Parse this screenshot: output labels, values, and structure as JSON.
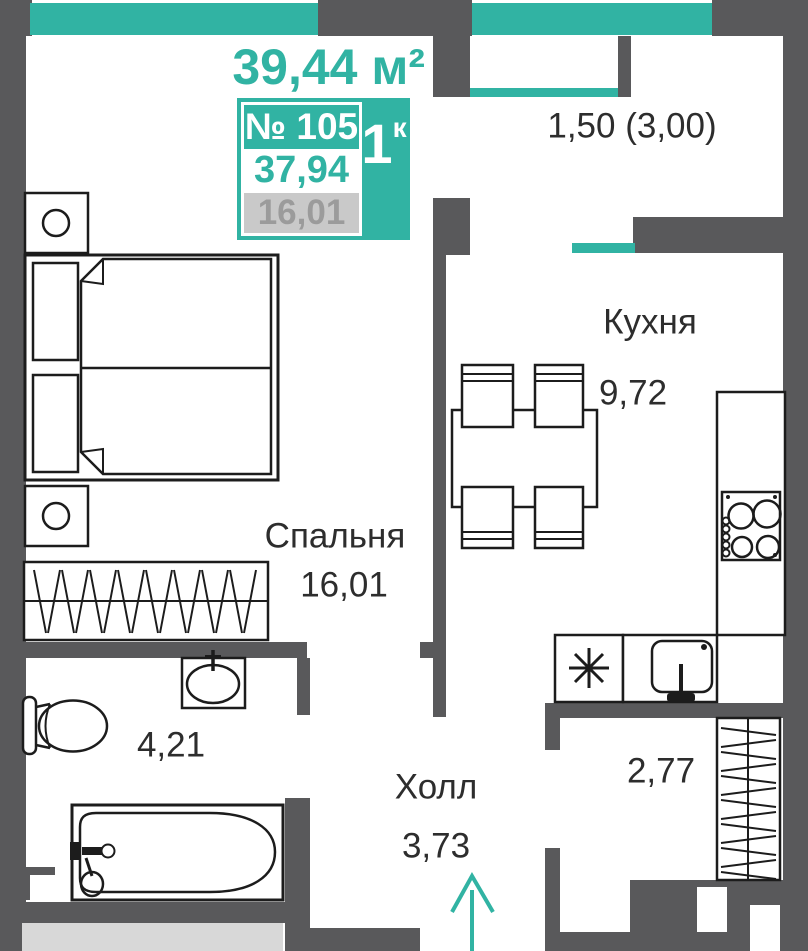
{
  "header": {
    "total_area": "39,44 м²",
    "unit_card": {
      "number": "№ 105",
      "rooms_count": "1",
      "rooms_suffix": "к",
      "total_area_value": "37,94",
      "living_area_value": "16,01"
    }
  },
  "rooms": {
    "balcony": {
      "area": "1,50 (3,00)"
    },
    "kitchen": {
      "name": "Кухня",
      "area": "9,72"
    },
    "bedroom": {
      "name": "Спальня",
      "area": "16,01"
    },
    "bathroom": {
      "area": "4,21"
    },
    "hall": {
      "name": "Холл",
      "area": "3,73"
    },
    "storage": {
      "area": "2,77"
    }
  },
  "icons": {
    "fridge": "asterisk-snowflake",
    "entrance": "arrow-up"
  },
  "colors": {
    "accent_teal": "#31b3a3",
    "wall_dark": "#59595b",
    "outside_gray": "#d8d8d8",
    "muted_value_gray": "#9b9b9b",
    "label_text": "#2d2d2d"
  }
}
